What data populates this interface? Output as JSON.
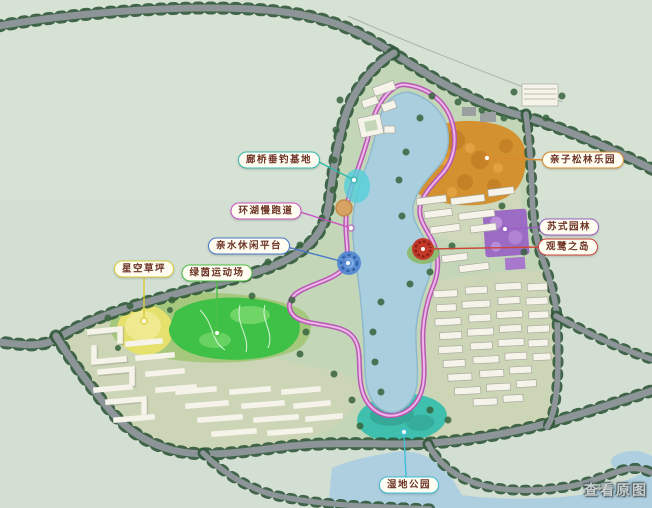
{
  "map": {
    "title": "residential-lake-park-master-plan",
    "callouts": [
      {
        "id": "fishing-base",
        "text": "廊桥垂钓基地",
        "color": "#35b8ad"
      },
      {
        "id": "jogging-track",
        "text": "环湖慢跑道",
        "color": "#c94fc0"
      },
      {
        "id": "waterfront-platform",
        "text": "亲水休闲平台",
        "color": "#4a78c8"
      },
      {
        "id": "starry-lawn",
        "text": "星空草坪",
        "color": "#d8cc3a"
      },
      {
        "id": "sports-field",
        "text": "绿茵运动场",
        "color": "#4bbf45"
      },
      {
        "id": "pine-park",
        "text": "亲子松林乐园",
        "color": "#d98a2e"
      },
      {
        "id": "su-garden",
        "text": "苏式园林",
        "color": "#9a5fc2"
      },
      {
        "id": "egret-island",
        "text": "观鹭之岛",
        "color": "#cc4538"
      },
      {
        "id": "wetland-park",
        "text": "湿地公园",
        "color": "#3ec0d8"
      }
    ],
    "watermark": {
      "text": "查看原图"
    },
    "palette": {
      "background": "#d2dfd2",
      "park_ground": "#c3d6b8",
      "lake": "#a9cede",
      "loop_track": "#b65ab2",
      "orange_zone": "#d4912f",
      "purple_zone": "#9c6cc5",
      "yellow_lawn": "#e6e06d",
      "green_field": "#3fc147",
      "wetland": "#3fbfad",
      "road": "#8d9599",
      "water_river": "#aecfdf",
      "building": "#f6f3ea"
    }
  }
}
